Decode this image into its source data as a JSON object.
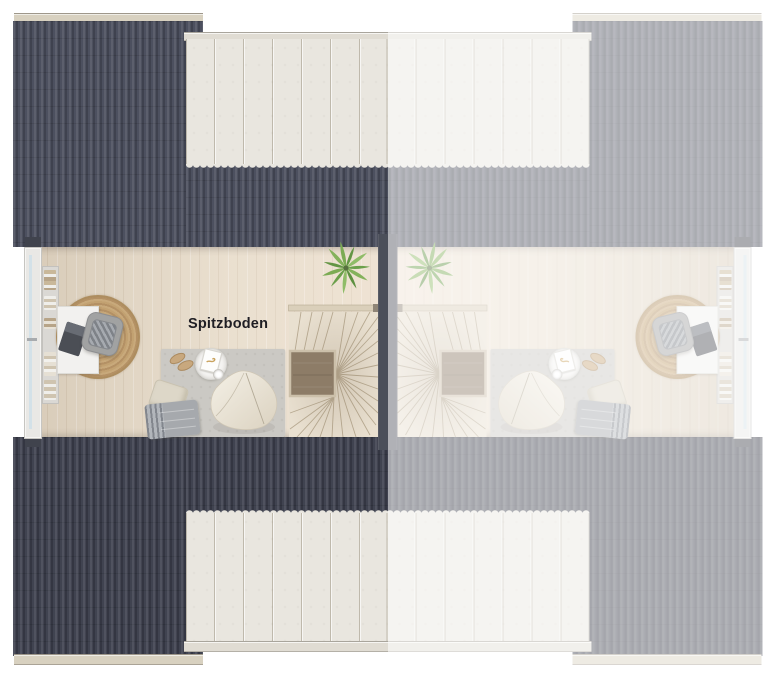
{
  "labels": {
    "room": "Spitzboden"
  },
  "theme": {
    "roofTopDark": "#494d5c",
    "roofBottomDark": "#3c3f4d",
    "dormer": "#e9e6df",
    "trim": "#d8d1c0",
    "floor": "#e4d9c7",
    "wall": "#4b4f5a",
    "glass": "#d3e1e8",
    "rugGray": "#cbc9c4",
    "jute": "#bb9a6c",
    "stairWood": "#e9e0d0",
    "stairVoid": "#8d7c67",
    "beanbag": "#efeadd",
    "plantGreen": "#74a44e",
    "text": "#1f1e24",
    "fadeOverlay": "rgba(255,255,255,0.56)"
  },
  "units": {
    "left": {
      "name": "left duplex unit",
      "style": "full color"
    },
    "right": {
      "name": "right duplex unit",
      "style": "mirrored, faded"
    }
  },
  "scene": {
    "view": "top-down attic floor plan",
    "elements": [
      "corrugated roof panels",
      "roof ridge trim",
      "eaves trim",
      "slatted dormer (top)",
      "slatted dormer (bottom)",
      "gable window",
      "bookshelf with books",
      "desk with laptop",
      "office chair",
      "round jute rug",
      "gray area rug",
      "beanbag chair",
      "side table with magazine and cup",
      "slippers",
      "pillow",
      "fringed blanket",
      "winder staircase with stairwell void and handrail",
      "potted fern plant",
      "party wall"
    ]
  }
}
